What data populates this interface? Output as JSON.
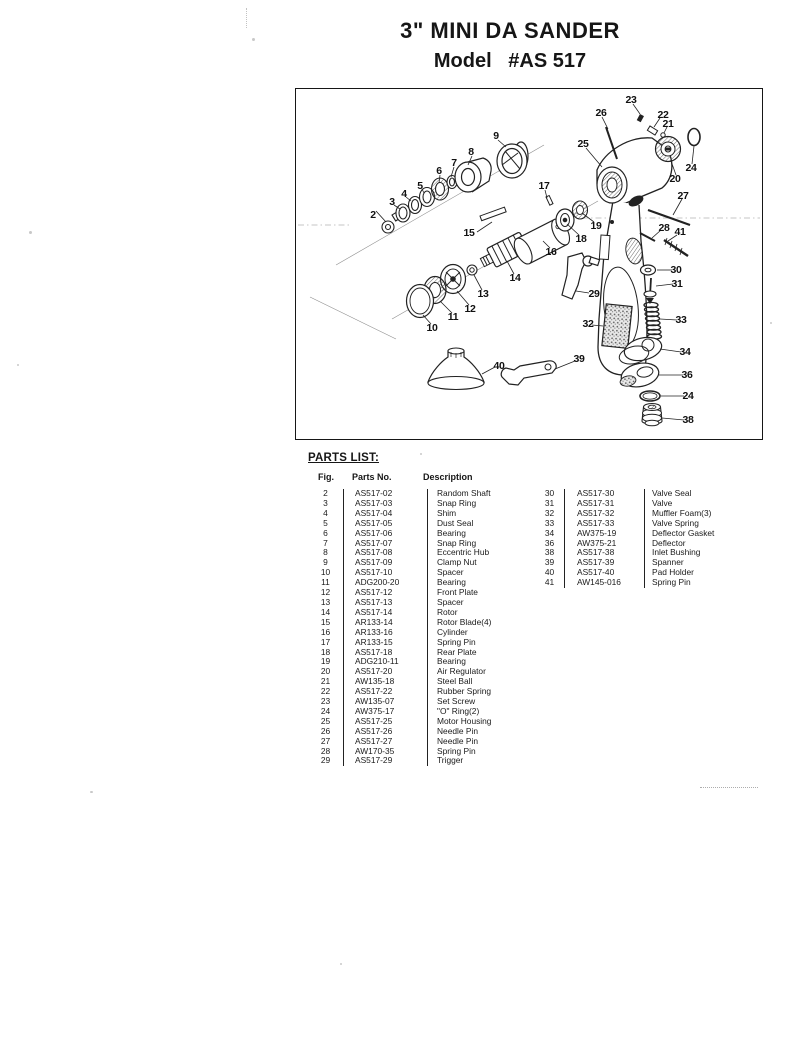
{
  "title": {
    "line1": "3\" MINI DA SANDER",
    "line2": "Model   #AS 517"
  },
  "parts_list": {
    "heading": "PARTS LIST:",
    "columns": {
      "fig": "Fig.",
      "part_no": "Parts No.",
      "description": "Description"
    },
    "left_rows": [
      {
        "fig": "2",
        "part_no": "AS517-02",
        "description": "Random Shaft"
      },
      {
        "fig": "3",
        "part_no": "AS517-03",
        "description": "Snap Ring"
      },
      {
        "fig": "4",
        "part_no": "AS517-04",
        "description": "Shim"
      },
      {
        "fig": "5",
        "part_no": "AS517-05",
        "description": "Dust Seal"
      },
      {
        "fig": "6",
        "part_no": "AS517-06",
        "description": "Bearing"
      },
      {
        "fig": "7",
        "part_no": "AS517-07",
        "description": "Snap Ring"
      },
      {
        "fig": "8",
        "part_no": "AS517-08",
        "description": "Eccentric Hub"
      },
      {
        "fig": "9",
        "part_no": "AS517-09",
        "description": "Clamp Nut"
      },
      {
        "fig": "10",
        "part_no": "AS517-10",
        "description": "Spacer"
      },
      {
        "fig": "11",
        "part_no": "ADG200-20",
        "description": "Bearing"
      },
      {
        "fig": "12",
        "part_no": "AS517-12",
        "description": "Front Plate"
      },
      {
        "fig": "13",
        "part_no": "AS517-13",
        "description": "Spacer"
      },
      {
        "fig": "14",
        "part_no": "AS517-14",
        "description": "Rotor"
      },
      {
        "fig": "15",
        "part_no": "AR133-14",
        "description": "Rotor Blade(4)"
      },
      {
        "fig": "16",
        "part_no": "AR133-16",
        "description": "Cylinder"
      },
      {
        "fig": "17",
        "part_no": "AR133-15",
        "description": "Spring Pin"
      },
      {
        "fig": "18",
        "part_no": "AS517-18",
        "description": "Rear Plate"
      },
      {
        "fig": "19",
        "part_no": "ADG210-11",
        "description": "Bearing"
      },
      {
        "fig": "20",
        "part_no": "AS517-20",
        "description": "Air Regulator"
      },
      {
        "fig": "21",
        "part_no": "AW135-18",
        "description": "Steel Ball"
      },
      {
        "fig": "22",
        "part_no": "AS517-22",
        "description": "Rubber Spring"
      },
      {
        "fig": "23",
        "part_no": "AW135-07",
        "description": "Set Screw"
      },
      {
        "fig": "24",
        "part_no": "AW375-17",
        "description": "\"O\" Ring(2)"
      },
      {
        "fig": "25",
        "part_no": "AS517-25",
        "description": "Motor Housing"
      },
      {
        "fig": "26",
        "part_no": "AS517-26",
        "description": "Needle Pin"
      },
      {
        "fig": "27",
        "part_no": "AS517-27",
        "description": "Needle Pin"
      },
      {
        "fig": "28",
        "part_no": "AW170-35",
        "description": "Spring Pin"
      },
      {
        "fig": "29",
        "part_no": "AS517-29",
        "description": "Trigger"
      }
    ],
    "right_rows": [
      {
        "fig": "30",
        "part_no": "AS517-30",
        "description": "Valve Seal"
      },
      {
        "fig": "31",
        "part_no": "AS517-31",
        "description": "Valve"
      },
      {
        "fig": "32",
        "part_no": "AS517-32",
        "description": "Muffler Foam(3)"
      },
      {
        "fig": "33",
        "part_no": "AS517-33",
        "description": "Valve Spring"
      },
      {
        "fig": "34",
        "part_no": "AW375-19",
        "description": "Deflector Gasket"
      },
      {
        "fig": "36",
        "part_no": "AW375-21",
        "description": "Deflector"
      },
      {
        "fig": "38",
        "part_no": "AS517-38",
        "description": "Inlet Bushing"
      },
      {
        "fig": "39",
        "part_no": "AS517-39",
        "description": "Spanner"
      },
      {
        "fig": "40",
        "part_no": "AS517-40",
        "description": "Pad Holder"
      },
      {
        "fig": "41",
        "part_no": "AW145-016",
        "description": "Spring Pin"
      }
    ]
  },
  "diagram": {
    "callouts": [
      {
        "label": "2",
        "x": 77,
        "y": 126
      },
      {
        "label": "3",
        "x": 96,
        "y": 113
      },
      {
        "label": "4",
        "x": 108,
        "y": 105
      },
      {
        "label": "5",
        "x": 124,
        "y": 97
      },
      {
        "label": "6",
        "x": 143,
        "y": 82
      },
      {
        "label": "7",
        "x": 158,
        "y": 74
      },
      {
        "label": "8",
        "x": 175,
        "y": 63
      },
      {
        "label": "9",
        "x": 200,
        "y": 47
      },
      {
        "label": "15",
        "x": 173,
        "y": 144
      },
      {
        "label": "17",
        "x": 248,
        "y": 97
      },
      {
        "label": "16",
        "x": 255,
        "y": 163
      },
      {
        "label": "18",
        "x": 285,
        "y": 150
      },
      {
        "label": "19",
        "x": 300,
        "y": 137
      },
      {
        "label": "25",
        "x": 287,
        "y": 55
      },
      {
        "label": "26",
        "x": 305,
        "y": 24
      },
      {
        "label": "23",
        "x": 335,
        "y": 11
      },
      {
        "label": "22",
        "x": 367,
        "y": 26
      },
      {
        "label": "21",
        "x": 372,
        "y": 35
      },
      {
        "label": "24",
        "x": 395,
        "y": 79
      },
      {
        "label": "20",
        "x": 379,
        "y": 90
      },
      {
        "label": "27",
        "x": 387,
        "y": 107
      },
      {
        "label": "28",
        "x": 368,
        "y": 139
      },
      {
        "label": "41",
        "x": 384,
        "y": 143
      },
      {
        "label": "14",
        "x": 219,
        "y": 189
      },
      {
        "label": "13",
        "x": 187,
        "y": 205
      },
      {
        "label": "12",
        "x": 174,
        "y": 220
      },
      {
        "label": "11",
        "x": 157,
        "y": 228
      },
      {
        "label": "10",
        "x": 136,
        "y": 239
      },
      {
        "label": "29",
        "x": 298,
        "y": 205
      },
      {
        "label": "30",
        "x": 380,
        "y": 181
      },
      {
        "label": "31",
        "x": 381,
        "y": 195
      },
      {
        "label": "32",
        "x": 292,
        "y": 235
      },
      {
        "label": "33",
        "x": 385,
        "y": 231
      },
      {
        "label": "34",
        "x": 389,
        "y": 263
      },
      {
        "label": "36",
        "x": 391,
        "y": 286
      },
      {
        "label": "24",
        "x": 392,
        "y": 307
      },
      {
        "label": "38",
        "x": 392,
        "y": 331
      },
      {
        "label": "40",
        "x": 203,
        "y": 277
      },
      {
        "label": "39",
        "x": 283,
        "y": 270
      }
    ]
  }
}
